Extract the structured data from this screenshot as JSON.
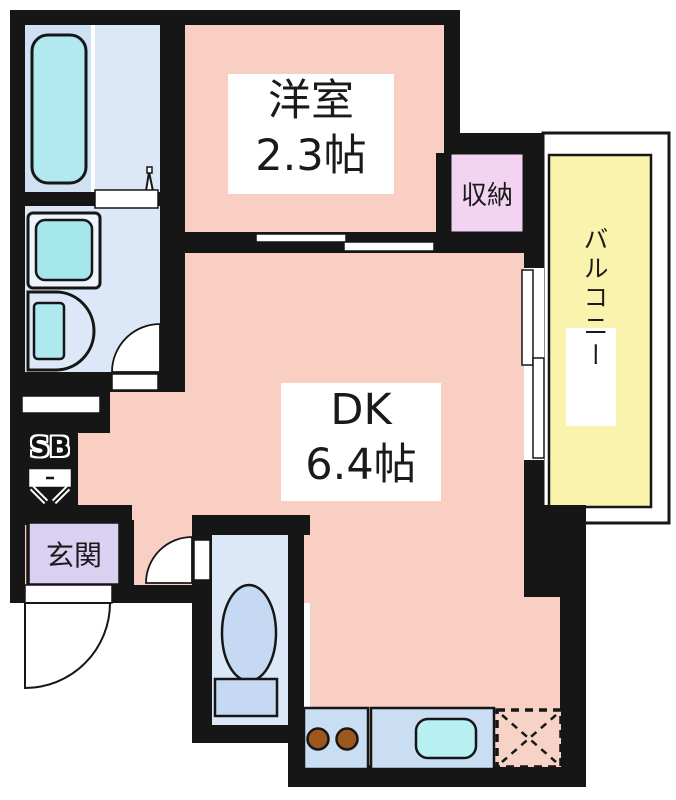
{
  "floorplan": {
    "western_room": {
      "name": "洋室",
      "size": "2.3帖"
    },
    "dining_kitchen": {
      "name": "DK",
      "size": "6.4帖"
    },
    "closet_label": "収納",
    "balcony_label": "バルコニー",
    "entrance_label": "玄関",
    "shoe_box_label": "SB",
    "colors": {
      "floor_pink": "#f9cfc3",
      "wet_area_blue": "#dce8f7",
      "bath_blue": "#cfe1f3",
      "fixture_cyan": "#b2e9f0",
      "balcony_yellow": "#faf3ae",
      "entrance_lavender": "#d9d0f2",
      "closet_pink": "#f2d3f2",
      "kitchen_counter_blue": "#c9ddf3",
      "toilet_fixture_blue": "#c5daf2",
      "burner_brown": "#9c571c",
      "wall_black": "#161616"
    }
  }
}
